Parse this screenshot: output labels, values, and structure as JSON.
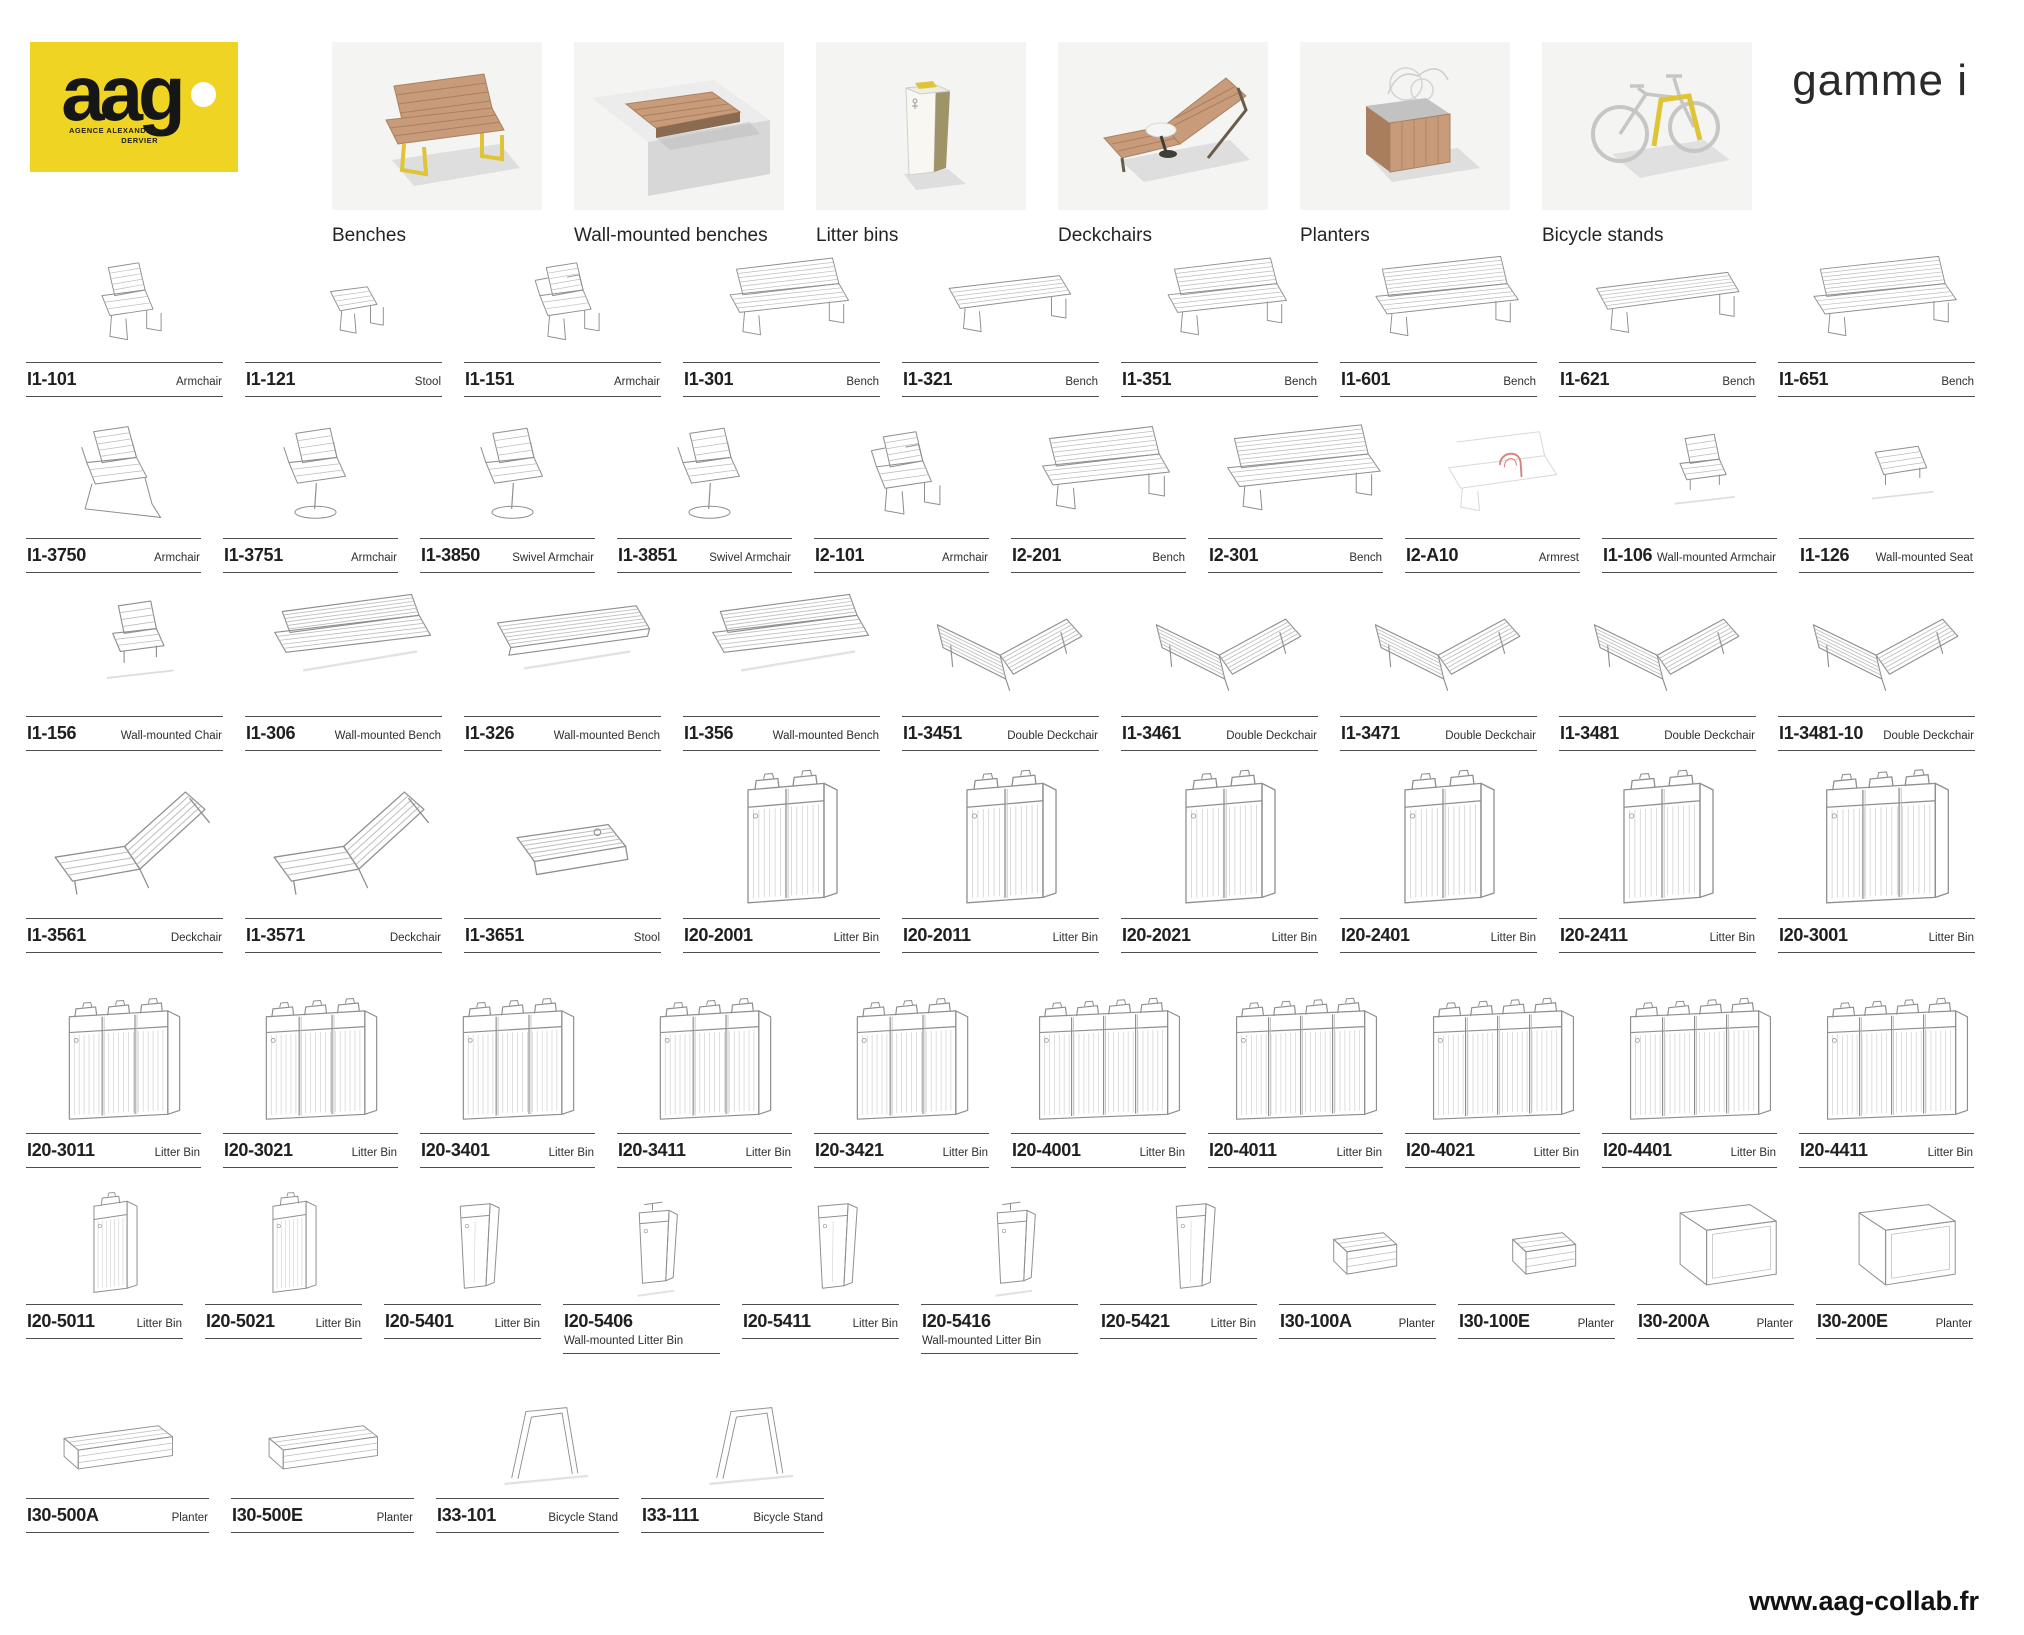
{
  "brand": {
    "logo_text": "aag",
    "logo_subtext_line1": "agence alexandra",
    "logo_subtext_line2": "dervier"
  },
  "header": {
    "range_label": "gamme i",
    "categories": [
      {
        "label": "Benches",
        "icon": "bench-thumb-icon"
      },
      {
        "label": "Wall-mounted benches",
        "icon": "wall-bench-thumb-icon"
      },
      {
        "label": "Litter bins",
        "icon": "litter-bin-thumb-icon"
      },
      {
        "label": "Deckchairs",
        "icon": "deckchair-thumb-icon"
      },
      {
        "label": "Planters",
        "icon": "planter-thumb-icon"
      },
      {
        "label": "Bicycle stands",
        "icon": "bicycle-stand-thumb-icon"
      }
    ]
  },
  "footer": {
    "website": "www.aag-collab.fr"
  },
  "colors": {
    "logo_yellow": "#F0D424",
    "accent_yellow": "#DFC437",
    "wood": "#C89B7B",
    "tile_background": "#F4F4F3",
    "sketch_stroke": "#8f8f8f",
    "armrest_highlight": "#D98080"
  },
  "product_rows": [
    {
      "items": [
        {
          "code": "I1-101",
          "type": "Armchair",
          "sketch": "chair"
        },
        {
          "code": "I1-121",
          "type": "Stool",
          "sketch": "stool"
        },
        {
          "code": "I1-151",
          "type": "Armchair",
          "sketch": "armchair"
        },
        {
          "code": "I1-301",
          "type": "Bench",
          "sketch": "bench"
        },
        {
          "code": "I1-321",
          "type": "Bench",
          "sketch": "bench_nb"
        },
        {
          "code": "I1-351",
          "type": "Bench",
          "sketch": "bench"
        },
        {
          "code": "I1-601",
          "type": "Bench",
          "sketch": "bench_long"
        },
        {
          "code": "I1-621",
          "type": "Bench",
          "sketch": "bench_nb_long"
        },
        {
          "code": "I1-651",
          "type": "Bench",
          "sketch": "bench_long"
        }
      ]
    },
    {
      "items": [
        {
          "code": "I1-3750",
          "type": "Armchair",
          "sketch": "lounge"
        },
        {
          "code": "I1-3751",
          "type": "Armchair",
          "sketch": "swivel"
        },
        {
          "code": "I1-3850",
          "type": "Swivel Armchair",
          "sketch": "swivel"
        },
        {
          "code": "I1-3851",
          "type": "Swivel Armchair",
          "sketch": "swivel"
        },
        {
          "code": "I2-101",
          "type": "Armchair",
          "sketch": "armchair"
        },
        {
          "code": "I2-201",
          "type": "Bench",
          "sketch": "bench"
        },
        {
          "code": "I2-301",
          "type": "Bench",
          "sketch": "bench_long"
        },
        {
          "code": "I2-A10",
          "type": "Armrest",
          "sketch": "armrest"
        },
        {
          "code": "I1-106",
          "type": "Wall-mounted Armchair",
          "sketch": "wall_chair"
        },
        {
          "code": "I1-126",
          "type": "Wall-mounted Seat",
          "sketch": "wall_seat"
        }
      ]
    },
    {
      "items": [
        {
          "code": "I1-156",
          "type": "Wall-mounted Chair",
          "sketch": "wall_chair"
        },
        {
          "code": "I1-306",
          "type": "Wall-mounted Bench",
          "sketch": "wall_bench"
        },
        {
          "code": "I1-326",
          "type": "Wall-mounted Bench",
          "sketch": "wall_bench_flat"
        },
        {
          "code": "I1-356",
          "type": "Wall-mounted Bench",
          "sketch": "wall_bench"
        },
        {
          "code": "I1-3451",
          "type": "Double Deckchair",
          "sketch": "double_deckchair"
        },
        {
          "code": "I1-3461",
          "type": "Double Deckchair",
          "sketch": "double_deckchair"
        },
        {
          "code": "I1-3471",
          "type": "Double Deckchair",
          "sketch": "double_deckchair"
        },
        {
          "code": "I1-3481",
          "type": "Double Deckchair",
          "sketch": "double_deckchair"
        },
        {
          "code": "I1-3481-10",
          "type": "Double Deckchair",
          "sketch": "double_deckchair"
        }
      ]
    },
    {
      "items": [
        {
          "code": "I1-3561",
          "type": "Deckchair",
          "sketch": "deckchair"
        },
        {
          "code": "I1-3571",
          "type": "Deckchair",
          "sketch": "deckchair"
        },
        {
          "code": "I1-3651",
          "type": "Stool",
          "sketch": "low_stool"
        },
        {
          "code": "I20-2001",
          "type": "Litter Bin",
          "sketch": "bin2"
        },
        {
          "code": "I20-2011",
          "type": "Litter Bin",
          "sketch": "bin2"
        },
        {
          "code": "I20-2021",
          "type": "Litter Bin",
          "sketch": "bin2"
        },
        {
          "code": "I20-2401",
          "type": "Litter Bin",
          "sketch": "bin2"
        },
        {
          "code": "I20-2411",
          "type": "Litter Bin",
          "sketch": "bin2"
        },
        {
          "code": "I20-3001",
          "type": "Litter Bin",
          "sketch": "bin3"
        }
      ]
    },
    {
      "items": [
        {
          "code": "I20-3011",
          "type": "Litter Bin",
          "sketch": "bin3"
        },
        {
          "code": "I20-3021",
          "type": "Litter Bin",
          "sketch": "bin3"
        },
        {
          "code": "I20-3401",
          "type": "Litter Bin",
          "sketch": "bin3"
        },
        {
          "code": "I20-3411",
          "type": "Litter Bin",
          "sketch": "bin3"
        },
        {
          "code": "I20-3421",
          "type": "Litter Bin",
          "sketch": "bin3"
        },
        {
          "code": "I20-4001",
          "type": "Litter Bin",
          "sketch": "bin4"
        },
        {
          "code": "I20-4011",
          "type": "Litter Bin",
          "sketch": "bin4"
        },
        {
          "code": "I20-4021",
          "type": "Litter Bin",
          "sketch": "bin4"
        },
        {
          "code": "I20-4401",
          "type": "Litter Bin",
          "sketch": "bin4"
        },
        {
          "code": "I20-4411",
          "type": "Litter Bin",
          "sketch": "bin4"
        }
      ]
    },
    {
      "items": [
        {
          "code": "I20-5011",
          "type": "Litter Bin",
          "sketch": "bin1"
        },
        {
          "code": "I20-5021",
          "type": "Litter Bin",
          "sketch": "bin1"
        },
        {
          "code": "I20-5401",
          "type": "Litter Bin",
          "sketch": "bin_slim"
        },
        {
          "code": "I20-5406",
          "type": "Wall-mounted Litter Bin",
          "sketch": "bin_wall"
        },
        {
          "code": "I20-5411",
          "type": "Litter Bin",
          "sketch": "bin_slim"
        },
        {
          "code": "I20-5416",
          "type": "Wall-mounted Litter Bin",
          "sketch": "bin_wall"
        },
        {
          "code": "I20-5421",
          "type": "Litter Bin",
          "sketch": "bin_slim"
        },
        {
          "code": "I30-100A",
          "type": "Planter",
          "sketch": "planter_small"
        },
        {
          "code": "I30-100E",
          "type": "Planter",
          "sketch": "planter_small"
        },
        {
          "code": "I30-200A",
          "type": "Planter",
          "sketch": "planter_large"
        },
        {
          "code": "I30-200E",
          "type": "Planter",
          "sketch": "planter_large"
        }
      ]
    },
    {
      "items": [
        {
          "code": "I30-500A",
          "type": "Planter",
          "sketch": "planter_long"
        },
        {
          "code": "I30-500E",
          "type": "Planter",
          "sketch": "planter_long"
        },
        {
          "code": "I33-101",
          "type": "Bicycle Stand",
          "sketch": "bike_stand"
        },
        {
          "code": "I33-111",
          "type": "Bicycle Stand",
          "sketch": "bike_stand"
        }
      ]
    }
  ]
}
